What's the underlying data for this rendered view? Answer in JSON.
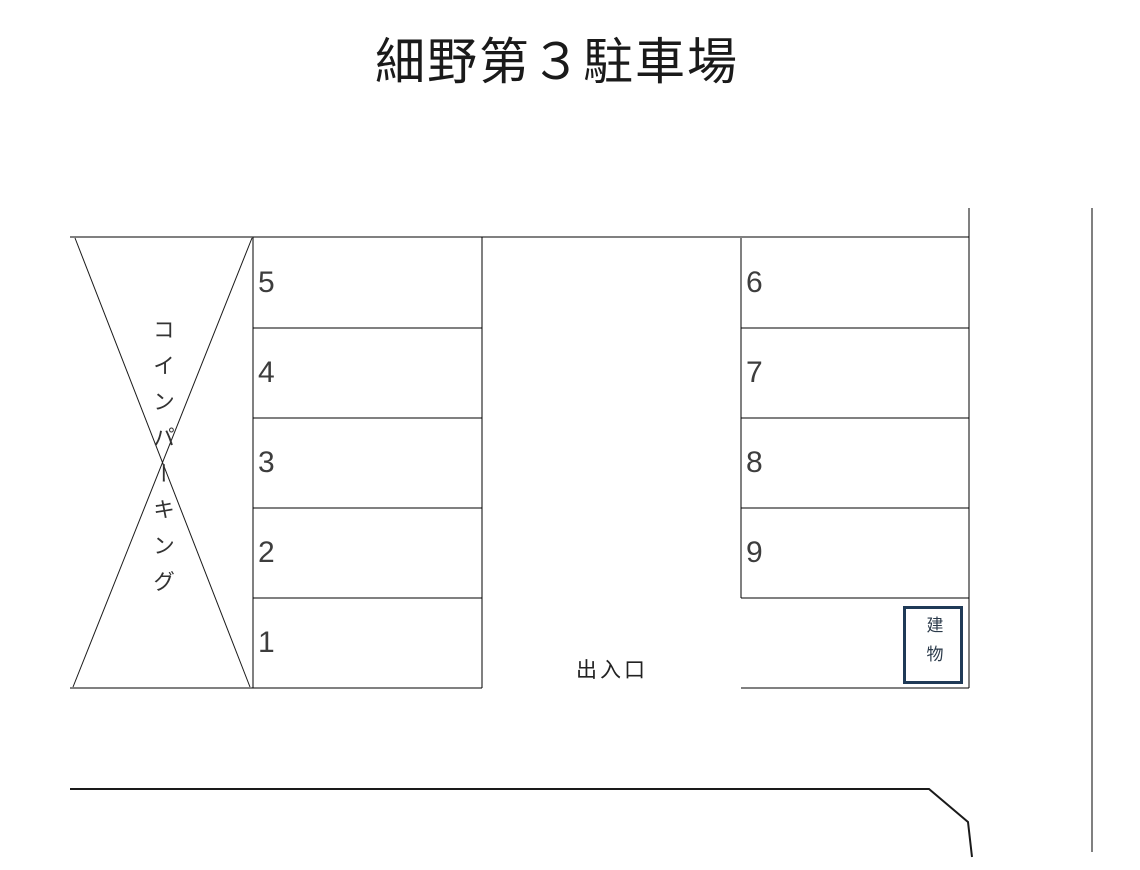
{
  "title": "細野第３駐車場",
  "coin_parking_label": "コインパーキング",
  "spaces": {
    "left": [
      "5",
      "4",
      "3",
      "2",
      "1"
    ],
    "right": [
      "6",
      "7",
      "8",
      "9"
    ]
  },
  "entrance_label": "出入口",
  "building_label": "建物",
  "colors": {
    "line": "#000000",
    "building_border": "#1f3a57",
    "number_text": "#3d3d3d",
    "title_text": "#1a1a1a"
  }
}
